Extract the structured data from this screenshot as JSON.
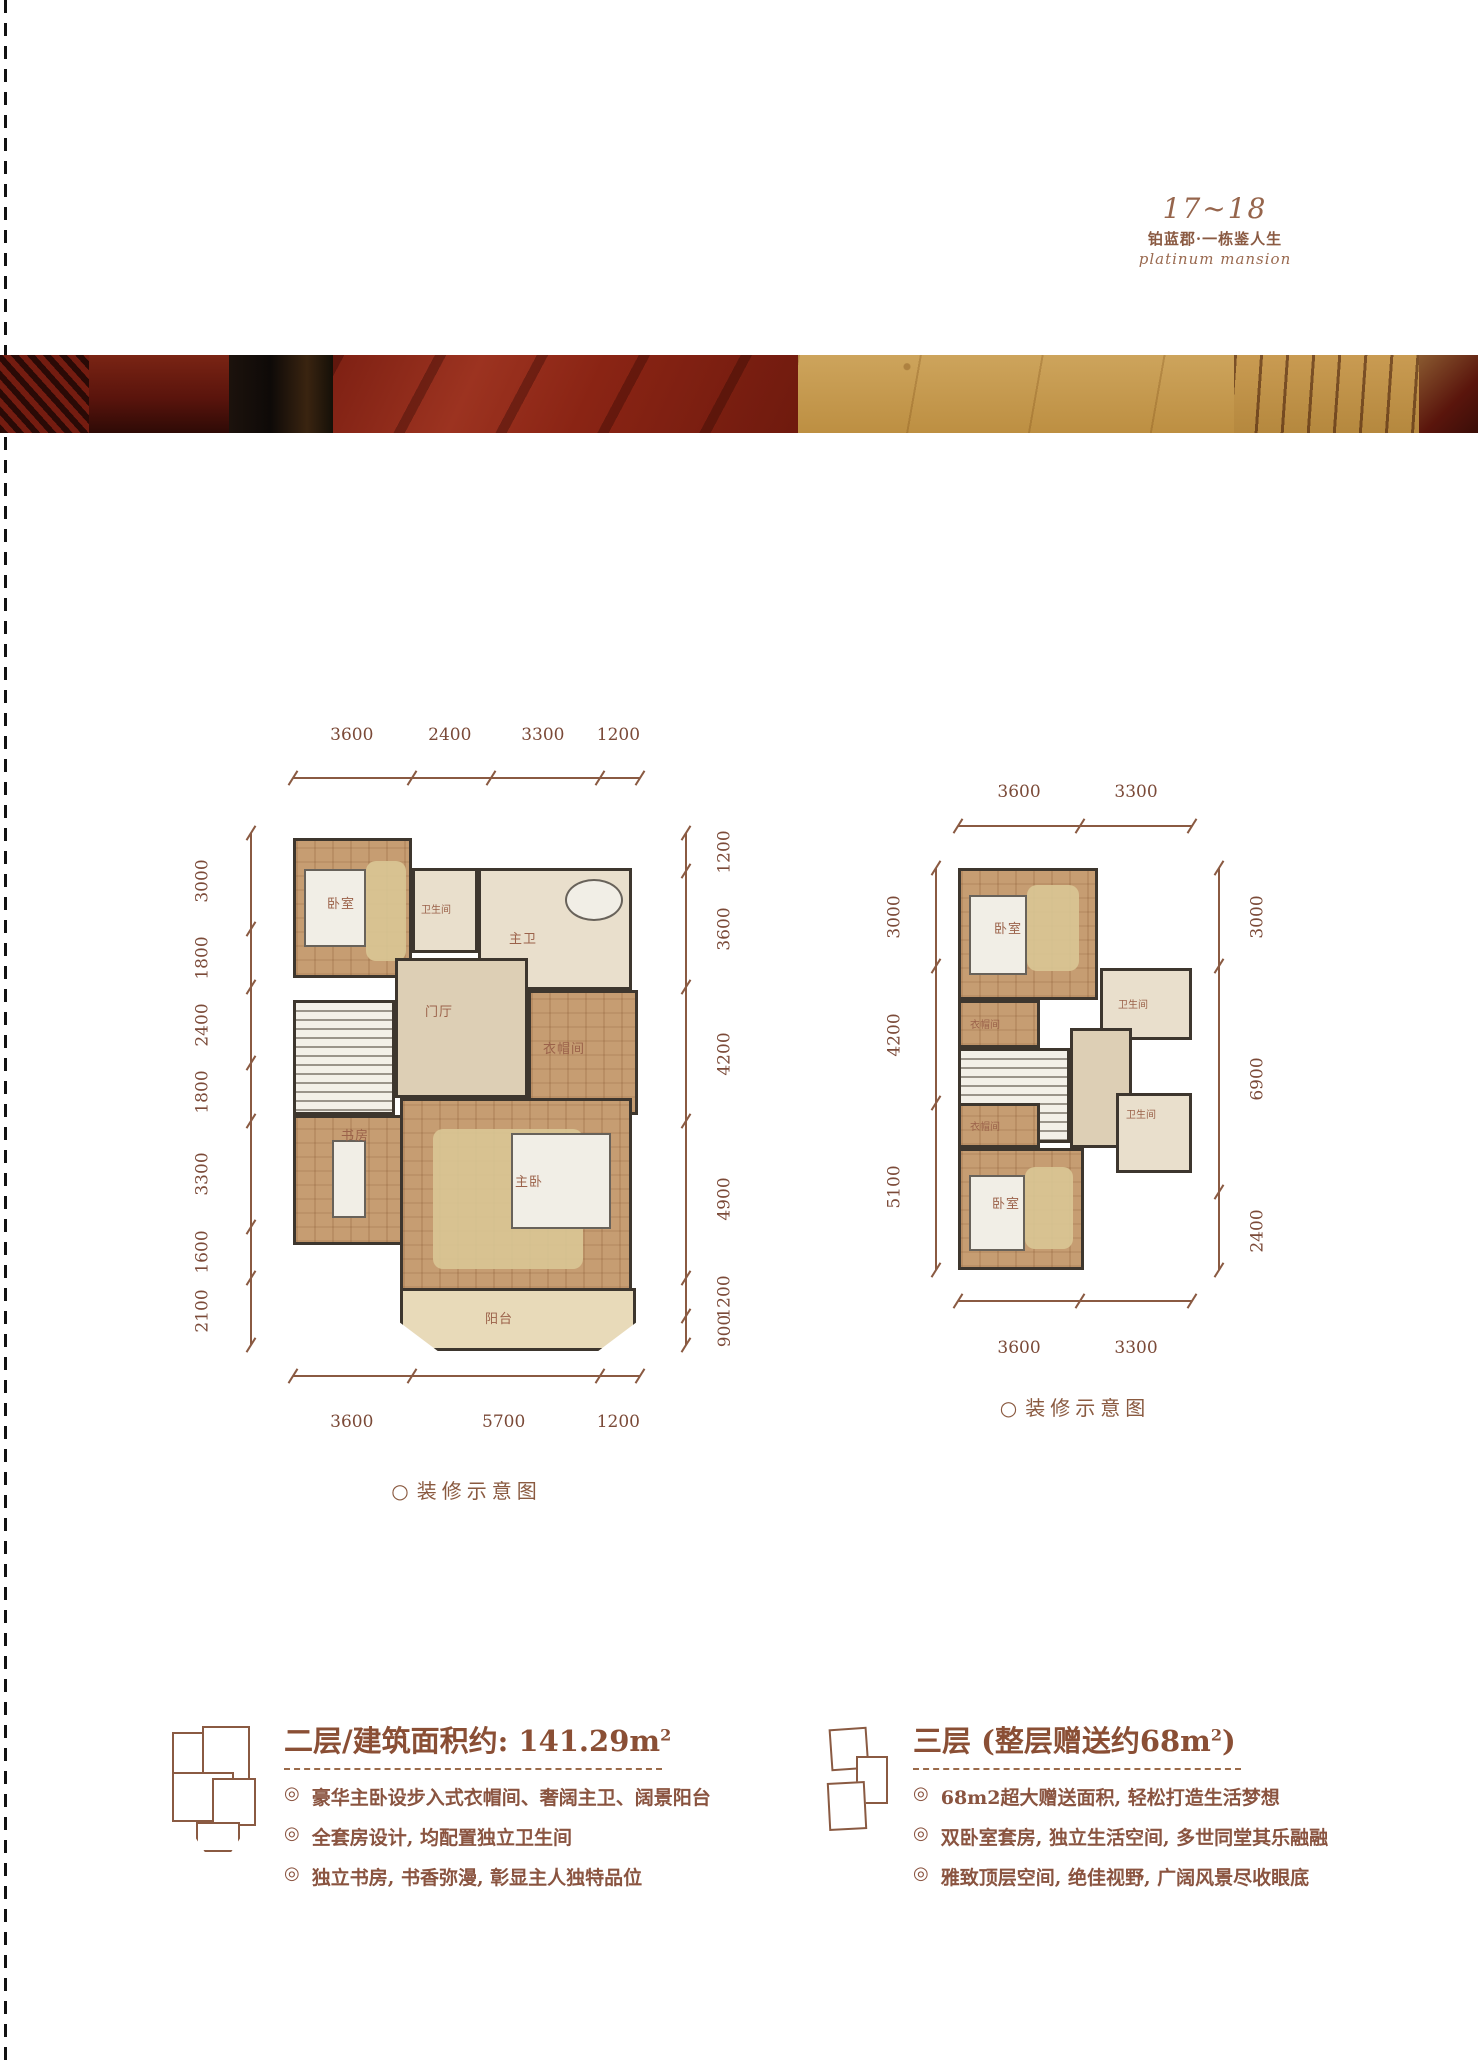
{
  "header": {
    "page_range": "17~18",
    "title_cn": "铂蓝郡·一栋鉴人生",
    "title_en": "platinum mansion"
  },
  "icons": {
    "bullet": "◎",
    "caption_circle": "○"
  },
  "plan2": {
    "caption": "装修示意图",
    "dims_top": [
      "3600",
      "2400",
      "3300",
      "1200"
    ],
    "dims_bottom": [
      "3600",
      "5700",
      "1200"
    ],
    "dims_left": [
      "3000",
      "1800",
      "2400",
      "1800",
      "3300",
      "1600",
      "2100"
    ],
    "dims_right": [
      "1200",
      "3600",
      "4200",
      "4900",
      "1200",
      "900"
    ],
    "rooms": {
      "bedroom": "卧室",
      "bath": "卫生间",
      "master_bath": "主卫",
      "foyer": "门厅",
      "cloak": "衣帽间",
      "study": "书房",
      "master_bedroom": "主卧",
      "balcony": "阳台"
    }
  },
  "plan3": {
    "caption": "装修示意图",
    "dims_top": [
      "3600",
      "3300"
    ],
    "dims_bottom": [
      "3600",
      "3300"
    ],
    "dims_left": [
      "3000",
      "4200",
      "5100"
    ],
    "dims_right": [
      "3000",
      "6900",
      "2400"
    ],
    "rooms": {
      "bedroom_top": "卧室",
      "cloak_top": "衣帽间",
      "bath_top": "卫生间",
      "bath_bottom": "卫生间",
      "cloak_bottom": "衣帽间",
      "bedroom_bottom": "卧室"
    }
  },
  "info2": {
    "title_main": "二层/建筑面积约: 141.29m",
    "title_sup": "2",
    "bullets": [
      "豪华主卧设步入式衣帽间、奢阔主卫、阔景阳台",
      "全套房设计, 均配置独立卫生间",
      "独立书房, 书香弥漫, 彰显主人独特品位"
    ]
  },
  "info3": {
    "title_main": "三层 (整层赠送约68m",
    "title_sup": "2",
    "title_suffix": ")",
    "bullets": [
      "68m2超大赠送面积, 轻松打造生活梦想",
      "双卧室套房, 独立生活空间, 多世同堂其乐融融",
      "雅致顶层空间, 绝佳视野, 广阔风景尽收眼底"
    ]
  }
}
